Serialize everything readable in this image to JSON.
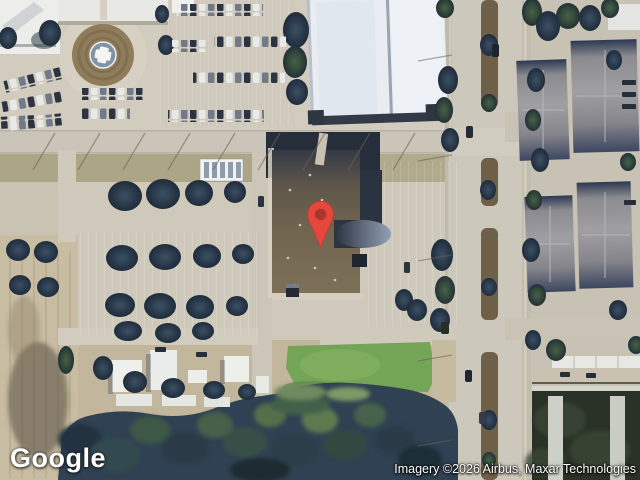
{
  "map": {
    "logo": "Google",
    "attribution": "Imagery ©2026 Airbus, Maxar Technologies",
    "pin": {
      "icon": "map-pin-icon",
      "body_color": "#E5473C",
      "outline_color": "#C6382D",
      "dot_color": "#A8362C"
    },
    "colors": {
      "pavement": "#cdc7b9",
      "road": "#cac5b8",
      "median_dirt": "#6e5f49",
      "tree_dark": "#2a3a4c",
      "tree_green": "#324739",
      "grass_field": "#74a556",
      "roof_white": "#e9edf2",
      "roof_gray": "#8e8e92",
      "roof_brown": "#71654f",
      "helipad_pad": "#8094a6",
      "helipad_cross": "#f4f6f4"
    }
  }
}
